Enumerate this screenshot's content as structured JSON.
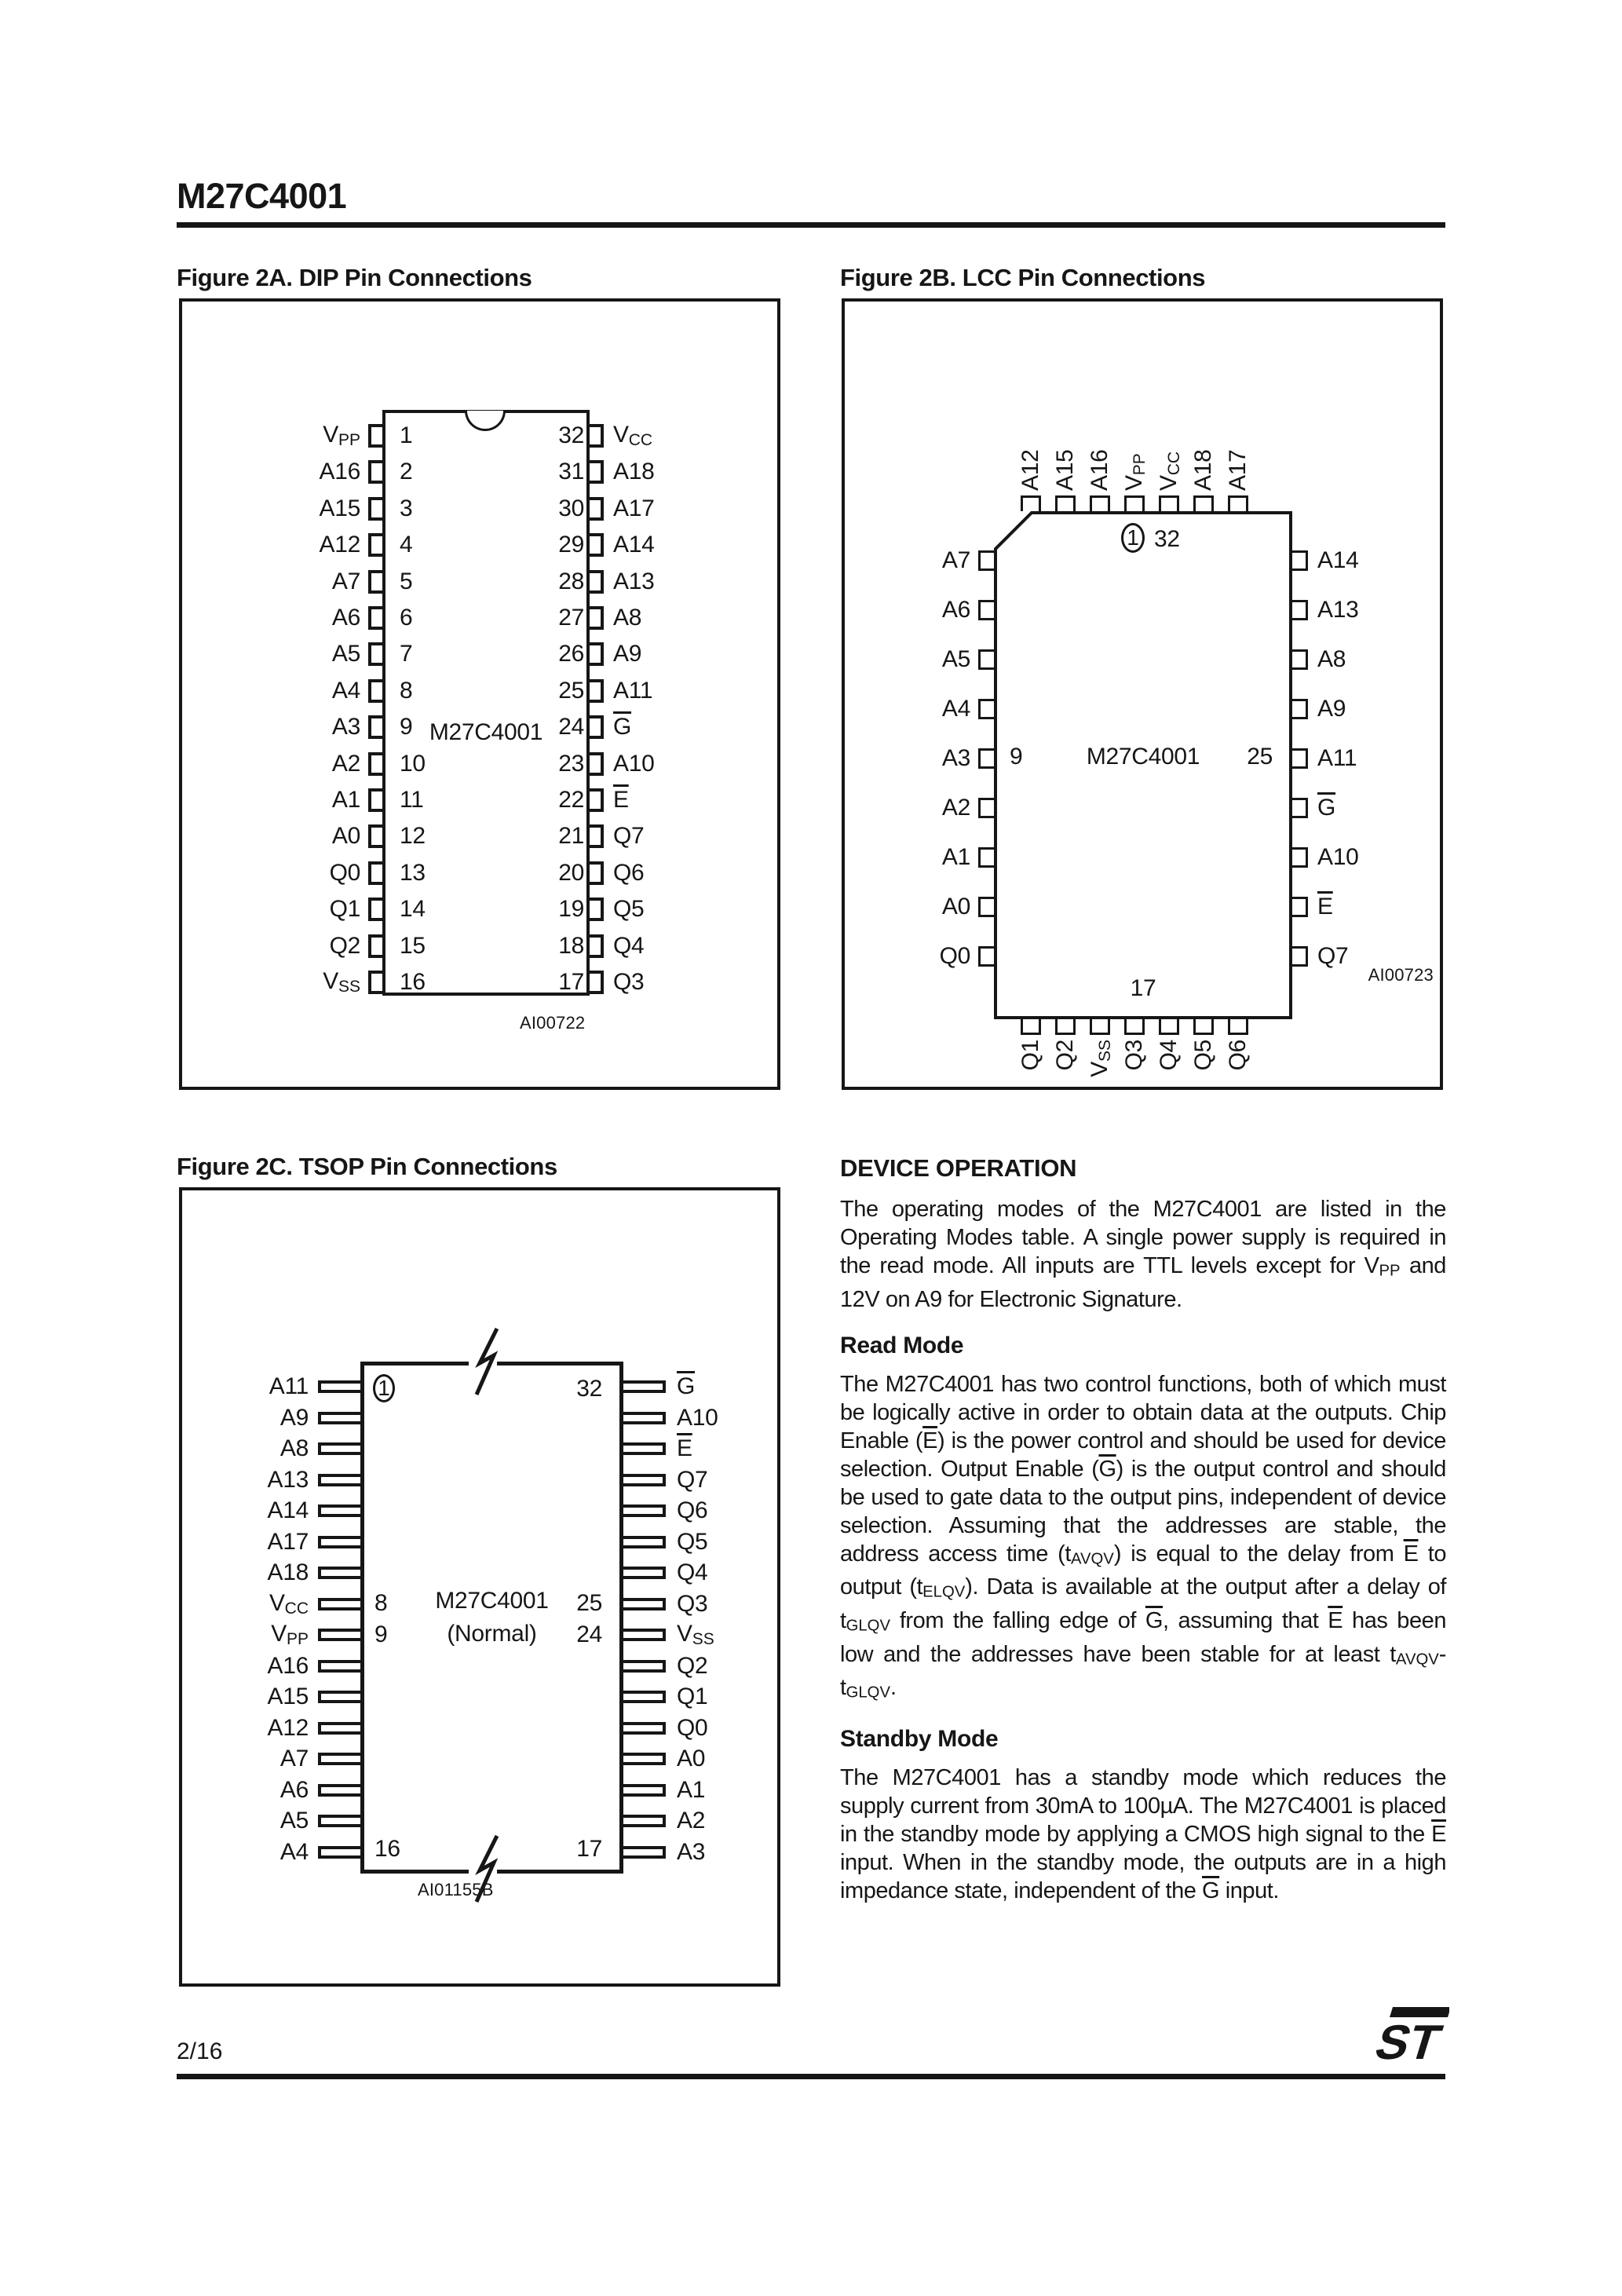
{
  "page": {
    "part_number": "M27C4001",
    "page_number": "2/16",
    "logo_text": "ST"
  },
  "figure_2a": {
    "title": "Figure 2A. DIP Pin Connections",
    "chip_label": "M27C4001",
    "code": "AI00722",
    "left_pins": [
      {
        "num": "1",
        "label": "V<sub>PP</sub>"
      },
      {
        "num": "2",
        "label": "A16"
      },
      {
        "num": "3",
        "label": "A15"
      },
      {
        "num": "4",
        "label": "A12"
      },
      {
        "num": "5",
        "label": "A7"
      },
      {
        "num": "6",
        "label": "A6"
      },
      {
        "num": "7",
        "label": "A5"
      },
      {
        "num": "8",
        "label": "A4"
      },
      {
        "num": "9",
        "label": "A3"
      },
      {
        "num": "10",
        "label": "A2"
      },
      {
        "num": "11",
        "label": "A1"
      },
      {
        "num": "12",
        "label": "A0"
      },
      {
        "num": "13",
        "label": "Q0"
      },
      {
        "num": "14",
        "label": "Q1"
      },
      {
        "num": "15",
        "label": "Q2"
      },
      {
        "num": "16",
        "label": "V<sub>SS</sub>"
      }
    ],
    "right_pins": [
      {
        "num": "32",
        "label": "V<sub>CC</sub>"
      },
      {
        "num": "31",
        "label": "A18"
      },
      {
        "num": "30",
        "label": "A17"
      },
      {
        "num": "29",
        "label": "A14"
      },
      {
        "num": "28",
        "label": "A13"
      },
      {
        "num": "27",
        "label": "A8"
      },
      {
        "num": "26",
        "label": "A9"
      },
      {
        "num": "25",
        "label": "A11"
      },
      {
        "num": "24",
        "label": "<span class='ov'>G</span>"
      },
      {
        "num": "23",
        "label": "A10"
      },
      {
        "num": "22",
        "label": "<span class='ov'>E</span>"
      },
      {
        "num": "21",
        "label": "Q7"
      },
      {
        "num": "20",
        "label": "Q6"
      },
      {
        "num": "19",
        "label": "Q5"
      },
      {
        "num": "18",
        "label": "Q4"
      },
      {
        "num": "17",
        "label": "Q3"
      }
    ]
  },
  "figure_2b": {
    "title": "Figure 2B. LCC Pin Connections",
    "chip_label": "M27C4001",
    "code": "AI00723",
    "top_pins": [
      "A12",
      "A15",
      "A16",
      "V<sub>PP</sub>",
      "V<sub>CC</sub>",
      "A18",
      "A17"
    ],
    "left_pins": [
      "A7",
      "A6",
      "A5",
      "A4",
      "A3",
      "A2",
      "A1",
      "A0",
      "Q0"
    ],
    "right_pins": [
      "A14",
      "A13",
      "A8",
      "A9",
      "A11",
      "<span class='ov'>G</span>",
      "A10",
      "<span class='ov'>E</span>",
      "Q7"
    ],
    "bottom_pins": [
      "Q1",
      "Q2",
      "V<sub>SS</sub>",
      "Q3",
      "Q4",
      "Q5",
      "Q6"
    ],
    "first_pin": "1",
    "pin32": "32",
    "pin9": "9",
    "pin25": "25",
    "pin17": "17"
  },
  "figure_2c": {
    "title": "Figure 2C. TSOP Pin Connections",
    "chip_label": "M27C4001",
    "chip_sublabel": "(Normal)",
    "code": "AI01155B",
    "left_pins": [
      "A11",
      "A9",
      "A8",
      "A13",
      "A14",
      "A17",
      "A18",
      "V<sub>CC</sub>",
      "V<sub>PP</sub>",
      "A16",
      "A15",
      "A12",
      "A7",
      "A6",
      "A5",
      "A4"
    ],
    "right_pins": [
      "<span class='ov'>G</span>",
      "A10",
      "<span class='ov'>E</span>",
      "Q7",
      "Q6",
      "Q5",
      "Q4",
      "Q3",
      "V<sub>SS</sub>",
      "Q2",
      "Q1",
      "Q0",
      "A0",
      "A1",
      "A2",
      "A3"
    ],
    "pin1": "1",
    "pin32": "32",
    "pin8": "8",
    "pin9": "9",
    "pin25": "25",
    "pin24": "24",
    "pin16": "16",
    "pin17": "17"
  },
  "device_operation": {
    "heading": "DEVICE OPERATION",
    "intro_html": "The operating modes of the M27C4001 are listed in the Operating Modes table. A single power supply is required in the read mode. All inputs are TTL levels except for V<sub>PP</sub> and 12V on A9 for Electronic Signature.",
    "read_mode_heading": "Read Mode",
    "read_mode_html": "The M27C4001 has two control functions, both of which must be logically active in order to obtain data at the outputs. Chip Enable (<span class='ov'>E</span>) is the power control and should be used for device selection. Output Enable (<span class='ov'>G</span>) is the output control and should be used to gate data to the output pins, independent of device selection. Assuming that the addresses are stable, the address access time (t<sub>AVQV</sub>) is equal to the delay from <span class='ov'>E</span> to output (t<sub>ELQV</sub>). Data is available at the output after a delay of t<sub>GLQV</sub> from the falling edge of <span class='ov'>G</span>, assuming that <span class='ov'>E</span> has been low and the addresses have been stable for at least t<sub>AVQV</sub>-t<sub>GLQV</sub>.",
    "standby_heading": "Standby Mode",
    "standby_html": "The M27C4001 has a standby mode which reduces the supply current from 30mA to 100µA. The M27C4001 is placed in the standby mode by applying a CMOS high signal to the <span class='ov'>E</span> input. When in the standby mode, the outputs are in a high impedance state, independent of the <span class='ov'>G</span> input."
  }
}
